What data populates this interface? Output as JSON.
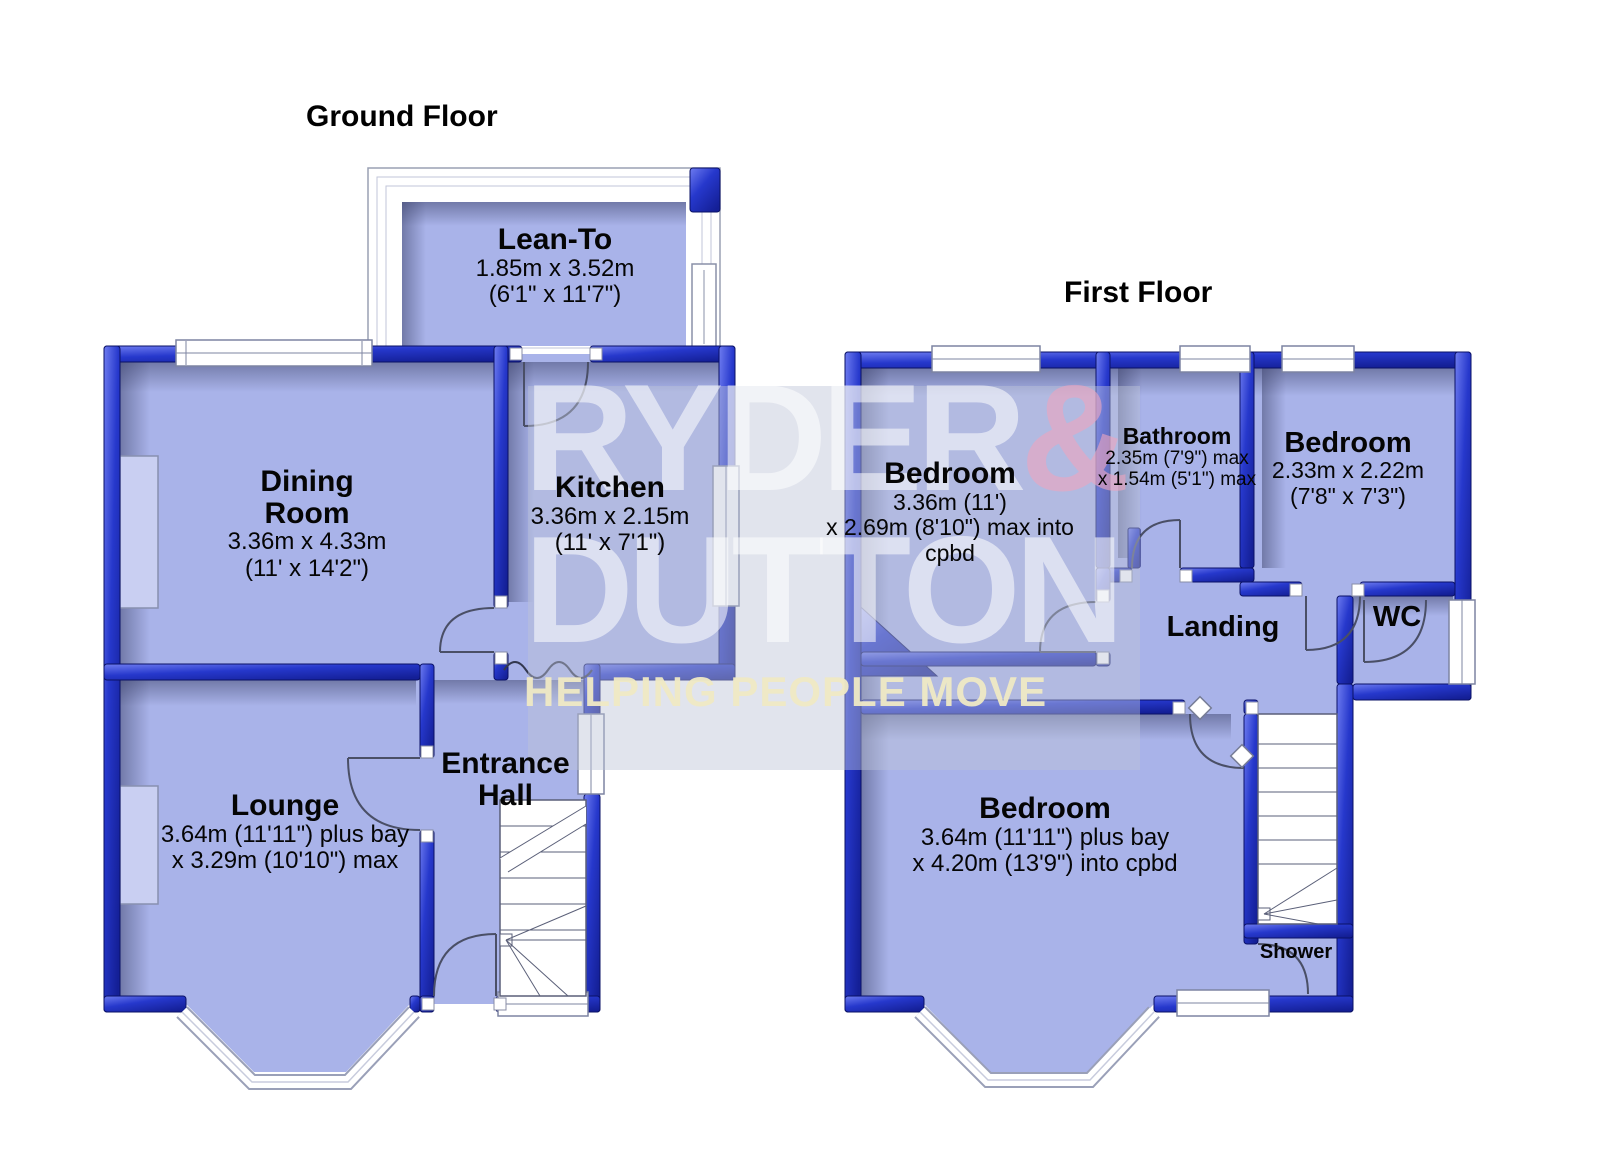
{
  "ground_floor": {
    "title": "Ground Floor",
    "rooms": {
      "lean_to": {
        "name": "Lean-To",
        "dim_metric": "1.85m x 3.52m",
        "dim_imperial": "(6'1\" x 11'7\")"
      },
      "dining_room": {
        "name": "Dining Room",
        "dim_metric": "3.36m x 4.33m",
        "dim_imperial": "(11' x 14'2\")"
      },
      "kitchen": {
        "name": "Kitchen",
        "dim_metric": "3.36m x 2.15m",
        "dim_imperial": "(11' x 7'1\")"
      },
      "lounge": {
        "name": "Lounge",
        "dim_line1": "3.64m (11'11\") plus bay",
        "dim_line2": "x 3.29m (10'10\") max"
      },
      "entrance_hall": {
        "name": "Entrance Hall"
      }
    }
  },
  "first_floor": {
    "title": "First Floor",
    "rooms": {
      "bedroom_front": {
        "name": "Bedroom",
        "dim_line1": "3.36m (11')",
        "dim_line2": "x 2.69m (8'10\") max into cpbd"
      },
      "bathroom": {
        "name": "Bathroom",
        "dim_line1": "2.35m (7'9\") max",
        "dim_line2": "x 1.54m (5'1\") max"
      },
      "bedroom_rear": {
        "name": "Bedroom",
        "dim_metric": "2.33m x 2.22m",
        "dim_imperial": "(7'8\" x 7'3\")"
      },
      "wc": {
        "name": "WC"
      },
      "landing": {
        "name": "Landing"
      },
      "bedroom_main": {
        "name": "Bedroom",
        "dim_line1": "3.64m (11'11\") plus bay",
        "dim_line2": "x 4.20m (13'9\") into cpbd"
      },
      "shower": {
        "name": "Shower"
      }
    }
  },
  "watermark": {
    "brand_top": "RYDER",
    "ampersand": "&",
    "brand_bottom": "DUTTON",
    "tagline": "HELPING PEOPLE MOVE",
    "brand_color": "#ffffff",
    "ampersand_color": "#eca4be",
    "tagline_color": "#efe9c4"
  },
  "colors": {
    "wall_blue": "#2334c4",
    "wall_outline": "#0a1166",
    "floor": "#a9b3e9",
    "background": "#ffffff"
  }
}
